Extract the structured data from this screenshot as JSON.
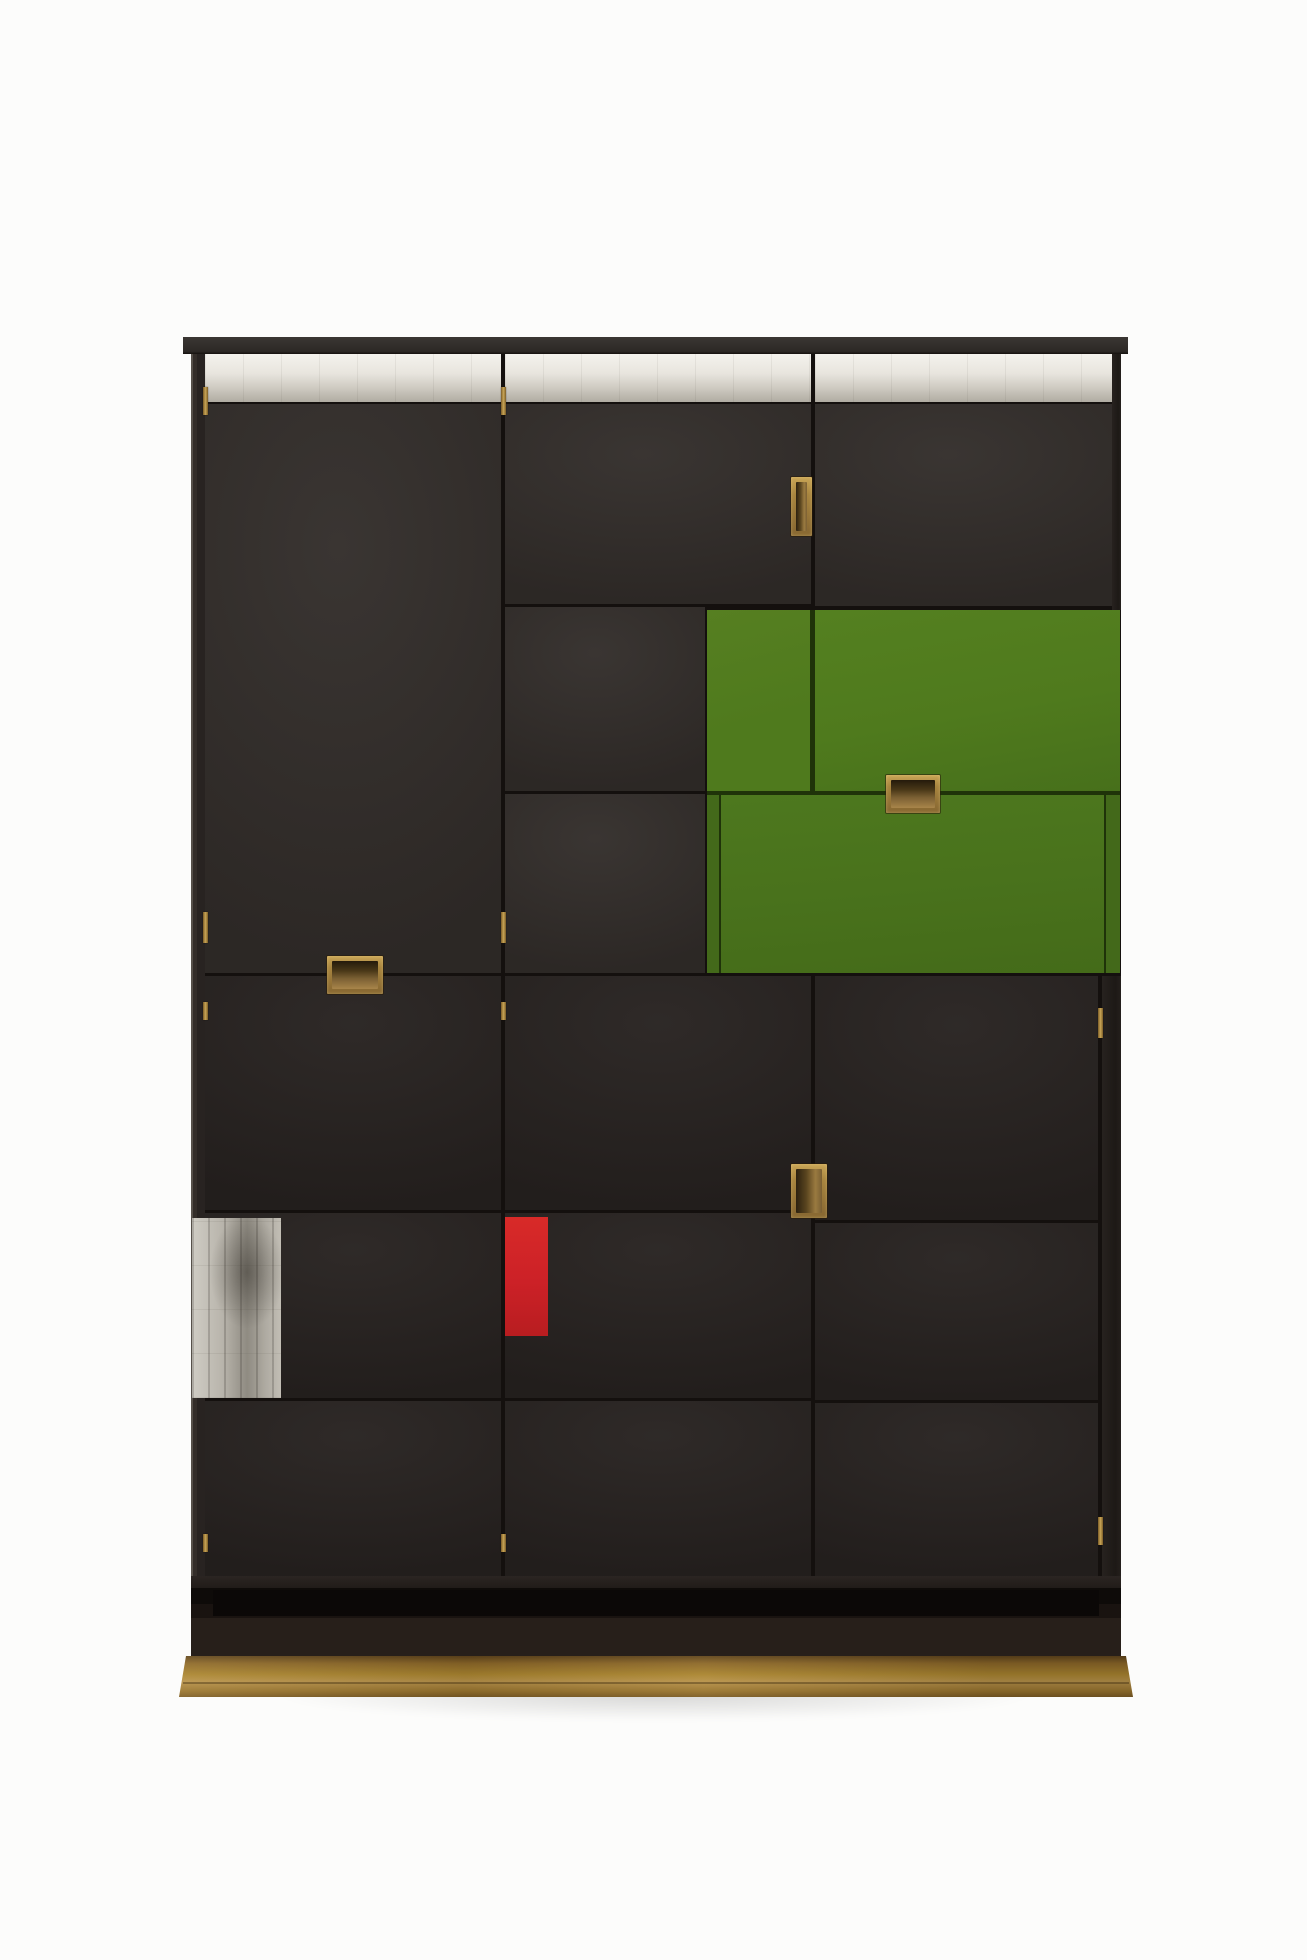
{
  "scene": {
    "type": "product-photograph",
    "subject": "modernist-cabinet-with-geometric-lacquer-panels",
    "visible_text": ""
  },
  "palette": {
    "bg": "#fcfcfb",
    "panel-dark": "#312c29",
    "panel-darker": "#282321",
    "panel-gap": "#14100e",
    "top-board": "#3b3734",
    "silver-bright": "#e9e6df",
    "silver-shaded": "#b0aca2",
    "silver-tarnish": "#8f8b82",
    "green-upper": "#4f7a1d",
    "green-lower": "#49721c",
    "green-seam": "#1f3309",
    "red-accent": "#cc2127",
    "brass-light": "#c9a556",
    "brass-mid": "#a8832f",
    "handle-recess": "#7a5f33",
    "plinth-dark": "#271f1a",
    "shadow": "rgba(0,0,0,0.14)"
  },
  "parts": {
    "top_board": "dark overhanging top board",
    "silver_frieze": "silver-leaf band across top, interrupted by door gaps",
    "doors": "dark stained door and drawer fronts in three columns",
    "green_flap_upper": "green lacquered fall-front, upper right",
    "green_drawer_lower": "green lacquered drawer front below",
    "red_panel": "small red lacquered rectangle, center left of middle column",
    "silver_patches": "two silver-leaf squares lower left and one long silver-leaf band",
    "handles": "four recessed brass pulls",
    "hinge_pins": "small exposed brass hinge pins along door gaps",
    "plinth": "stepped dark plinth",
    "brass_base": "brass-clad base plinth"
  }
}
